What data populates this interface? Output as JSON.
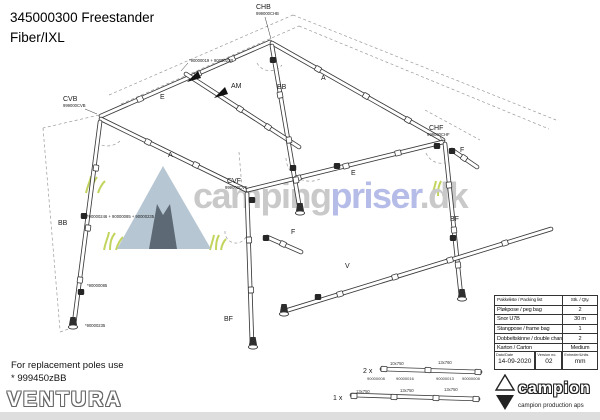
{
  "title": {
    "line1": "345000300 Freestander",
    "line2": "Fiber/IXL"
  },
  "watermark": {
    "part1": "camping",
    "part2": "priser",
    "part3": ".dk"
  },
  "diagram": {
    "corners": {
      "chb": {
        "label": "CHB",
        "part": "999000CHB"
      },
      "cvb": {
        "label": "CVB",
        "part": "999000CVB"
      },
      "cvf": {
        "label": "CVF",
        "part": "999000CVF"
      },
      "chf": {
        "label": "CHF",
        "part": "999000CHF"
      }
    },
    "pole_labels": {
      "e_back": "E",
      "e_front": "E",
      "a_left": "A",
      "a_right": "A",
      "am": "AM",
      "bb_top": "BB",
      "bb_leg": "BB",
      "bf_right": "BF",
      "bf_front": "BF",
      "f_front": "F",
      "f_right": "F",
      "v": "V"
    },
    "notes": {
      "ridge": "*90000019 + 9000023B",
      "leg_top": "*90000246 + 90000085 + 90000235",
      "leg_mid": "*90000085",
      "leg_foot": "*90000235"
    }
  },
  "spare_poles": {
    "row1": {
      "qty": "2 x",
      "dims": [
        "10x750",
        "13x760"
      ],
      "parts": [
        "90000008",
        "90000016",
        "90000013",
        "90000008"
      ]
    },
    "row2": {
      "qty": "1 x",
      "dims": [
        "13x750",
        "13x750",
        "13x750"
      ]
    }
  },
  "packing_table": {
    "header": {
      "name": "Pakkeliste / Packing list",
      "qty": "Stk. / Qty."
    },
    "rows": [
      {
        "name": "Pløkpose / peg bag",
        "qty": "2"
      },
      {
        "name": "Snor U7B",
        "qty": "30 m"
      },
      {
        "name": "Stangpose / frame bag",
        "qty": "1"
      },
      {
        "name": "Dobbeltskinne / double channel",
        "qty": "2"
      },
      {
        "name": "Karton / Carton",
        "qty": "Medium"
      }
    ]
  },
  "info_row": {
    "date_label": "Dato/Date",
    "date": "14-09-2020",
    "version_label": "Version no.",
    "version": "02",
    "units_label": "Enheder/Units",
    "units": "mm"
  },
  "replacement_note": {
    "line1": "For replacement poles use",
    "line2": "* 999450zBB"
  },
  "logos": {
    "ventura": "VENTURA",
    "campion": "campion",
    "campion_sub": "campion production aps"
  }
}
